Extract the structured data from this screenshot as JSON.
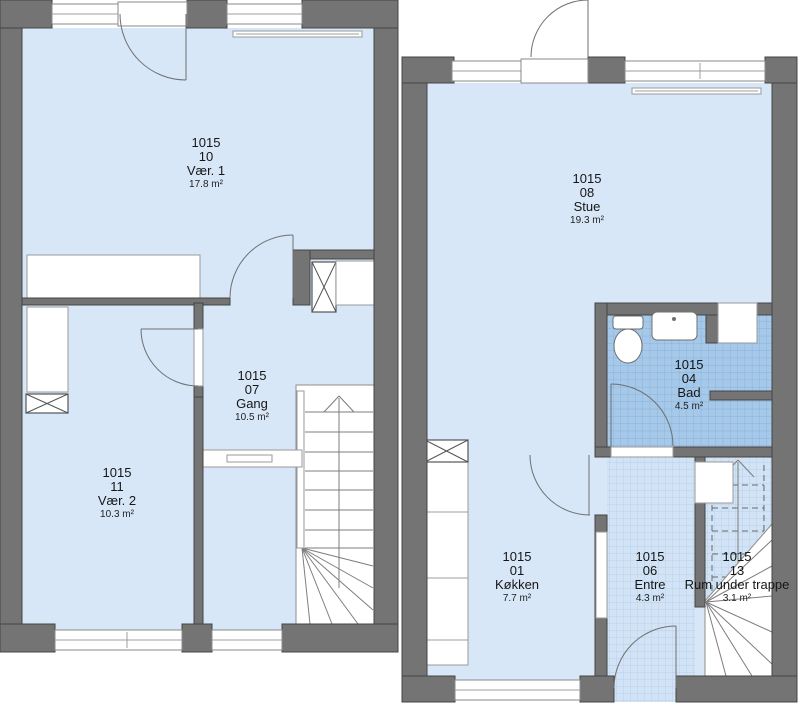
{
  "plan": {
    "type": "floor-plan",
    "language": "da",
    "units_shown": [
      "1015"
    ]
  },
  "colors": {
    "wall_gray": "#747474",
    "wall_edge": "#454545",
    "floor_blue": "#d7e7f8",
    "bad_tile": "#a6c9ea",
    "bad_tile_grid": "#7fa9d2",
    "entre_tile": "#d2e3f5",
    "entre_tile_grid": "#afcdea",
    "background": "#ffffff",
    "text": "#161616"
  },
  "rooms": [
    {
      "id": "vaer-1",
      "unit": "1015",
      "number": "10",
      "name": "Vær. 1",
      "area": "17.8 m²"
    },
    {
      "id": "vaer-2",
      "unit": "1015",
      "number": "11",
      "name": "Vær. 2",
      "area": "10.3 m²"
    },
    {
      "id": "gang",
      "unit": "1015",
      "number": "07",
      "name": "Gang",
      "area": "10.5 m²"
    },
    {
      "id": "stue",
      "unit": "1015",
      "number": "08",
      "name": "Stue",
      "area": "19.3 m²"
    },
    {
      "id": "bad",
      "unit": "1015",
      "number": "04",
      "name": "Bad",
      "area": "4.5 m²"
    },
    {
      "id": "koekken",
      "unit": "1015",
      "number": "01",
      "name": "Køkken",
      "area": "7.7 m²"
    },
    {
      "id": "entre",
      "unit": "1015",
      "number": "06",
      "name": "Entre",
      "area": "4.3 m²"
    },
    {
      "id": "rum-under-trappe",
      "unit": "1015",
      "number": "13",
      "name": "Rum under trappe",
      "area": "3.1 m²"
    }
  ]
}
